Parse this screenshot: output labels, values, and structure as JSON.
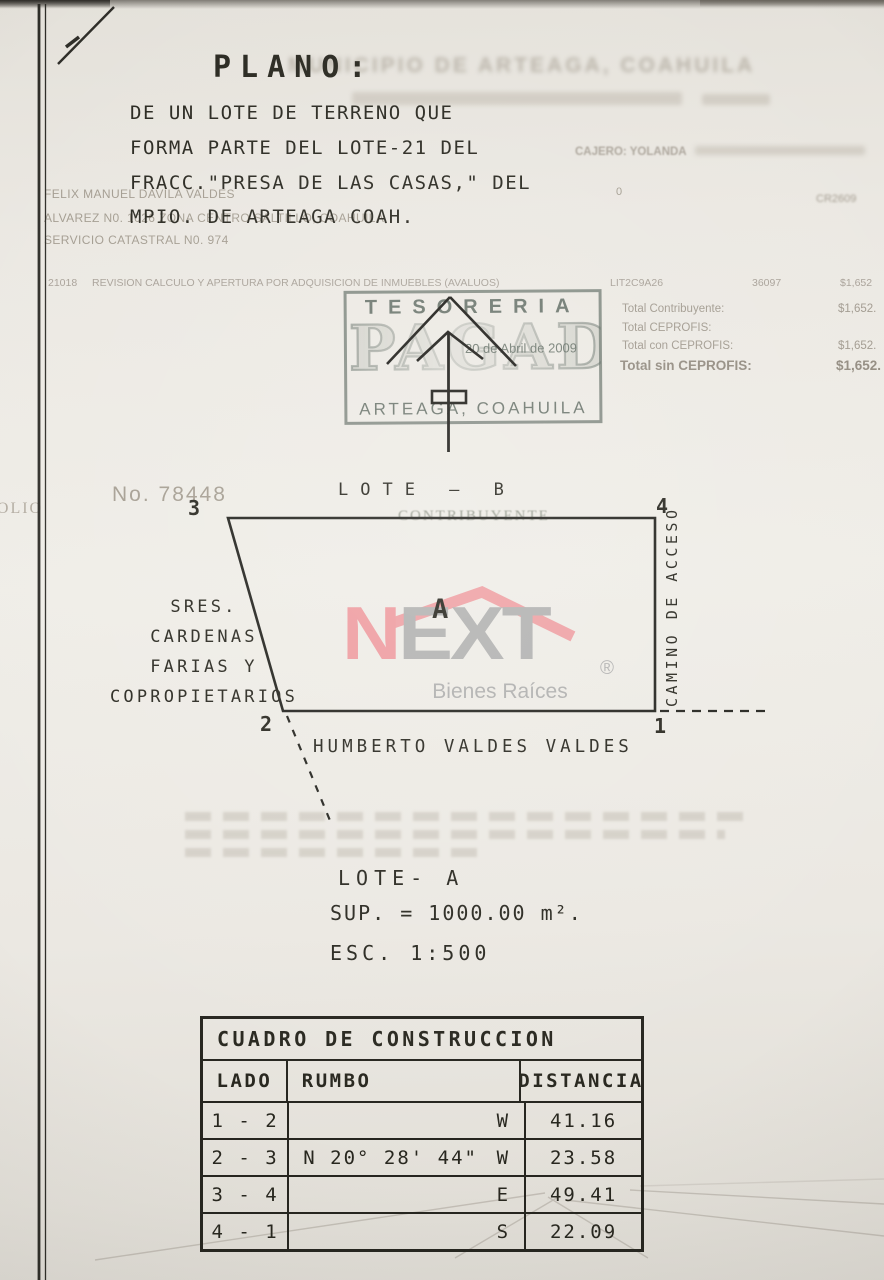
{
  "header": {
    "title": "PLANO:",
    "description_lines": [
      "DE UN LOTE DE TERRENO QUE",
      "FORMA PARTE DEL LOTE-21 DEL",
      "FRACC.\"PRESA DE LAS CASAS,\" DEL",
      "MPIO. DE ARTEAGA COAH."
    ],
    "ghost_municipio": "MUNICIPIO DE ARTEAGA, COAHUILA",
    "ghost_cajero": "CAJERO: YOLANDA",
    "ghost_zero": "0",
    "ghost_ref": "CR2609"
  },
  "ghost_owner": {
    "line1": "FELIX MANUEL DAVILA VALDES",
    "line2": "ALVAREZ N0. 1026 ZONA CENTRO SALTILLO, COAHUILA,",
    "line3": "SERVICIO CATASTRAL N0. 974"
  },
  "receipt": {
    "code": "21018",
    "concept": "REVISION CALCULO Y APERTURA POR ADQUISICION DE INMUEBLES (AVALUOS)",
    "lit": "LIT2C9A26",
    "folio_num": "36097",
    "amount": "$1,652",
    "totals": [
      {
        "label": "Total Contribuyente:",
        "value": "$1,652."
      },
      {
        "label": "Total CEPROFIS:",
        "value": ""
      },
      {
        "label": "Total con CEPROFIS:",
        "value": "$1,652."
      },
      {
        "label": "Total sin CEPROFIS:",
        "value": "$1,652."
      }
    ]
  },
  "stamp": {
    "office": "TESORERIA",
    "status": "PAGADO",
    "date": "20 de Abril de 2009",
    "place": "ARTEAGA, COAHUILA"
  },
  "plan": {
    "doc_no": "No. 78448",
    "folio_ghost": "FOLIO",
    "lote_b": "LOTE — B",
    "contribuyente_ghost": "CONTRIBUYENTE",
    "corners": {
      "p1": "1",
      "p2": "2",
      "p3": "3",
      "p4": "4"
    },
    "label_a": "A",
    "camino": "CAMINO DE ACCESO",
    "neighbors_left": [
      "SRES.",
      "CARDENAS",
      "FARIAS Y",
      "COPROPIETARIOS"
    ],
    "neighbor_bottom": "HUMBERTO VALDES VALDES"
  },
  "logo": {
    "n": "N",
    "ext": "EXT",
    "reg": "®",
    "tagline": "Bienes Raíces",
    "pink": "#ef8f94",
    "gray": "#a8a8a8"
  },
  "lot_info": {
    "name": "LOTE- A",
    "sup": "SUP. = 1000.00 m².",
    "esc": "ESC. 1:500"
  },
  "table": {
    "title": "CUADRO DE CONSTRUCCION",
    "headers": [
      "LADO",
      "RUMBO",
      "DISTANCIA"
    ],
    "rows": [
      {
        "lado": "1 - 2",
        "rumbo": "",
        "dir": "W",
        "dist": "41.16"
      },
      {
        "lado": "2 - 3",
        "rumbo": "N 20° 28' 44\"",
        "dir": "W",
        "dist": "23.58"
      },
      {
        "lado": "3 - 4",
        "rumbo": "",
        "dir": "E",
        "dist": "49.41"
      },
      {
        "lado": "4 - 1",
        "rumbo": "",
        "dir": "S",
        "dist": "22.09"
      }
    ]
  },
  "colors": {
    "ink": "#28271f",
    "ghost_text": "#a39c90",
    "stamp_green": "#67726a",
    "logo_pink": "#ef8f94",
    "logo_gray": "#a8a8a8",
    "paper": "#ebe8e2"
  }
}
